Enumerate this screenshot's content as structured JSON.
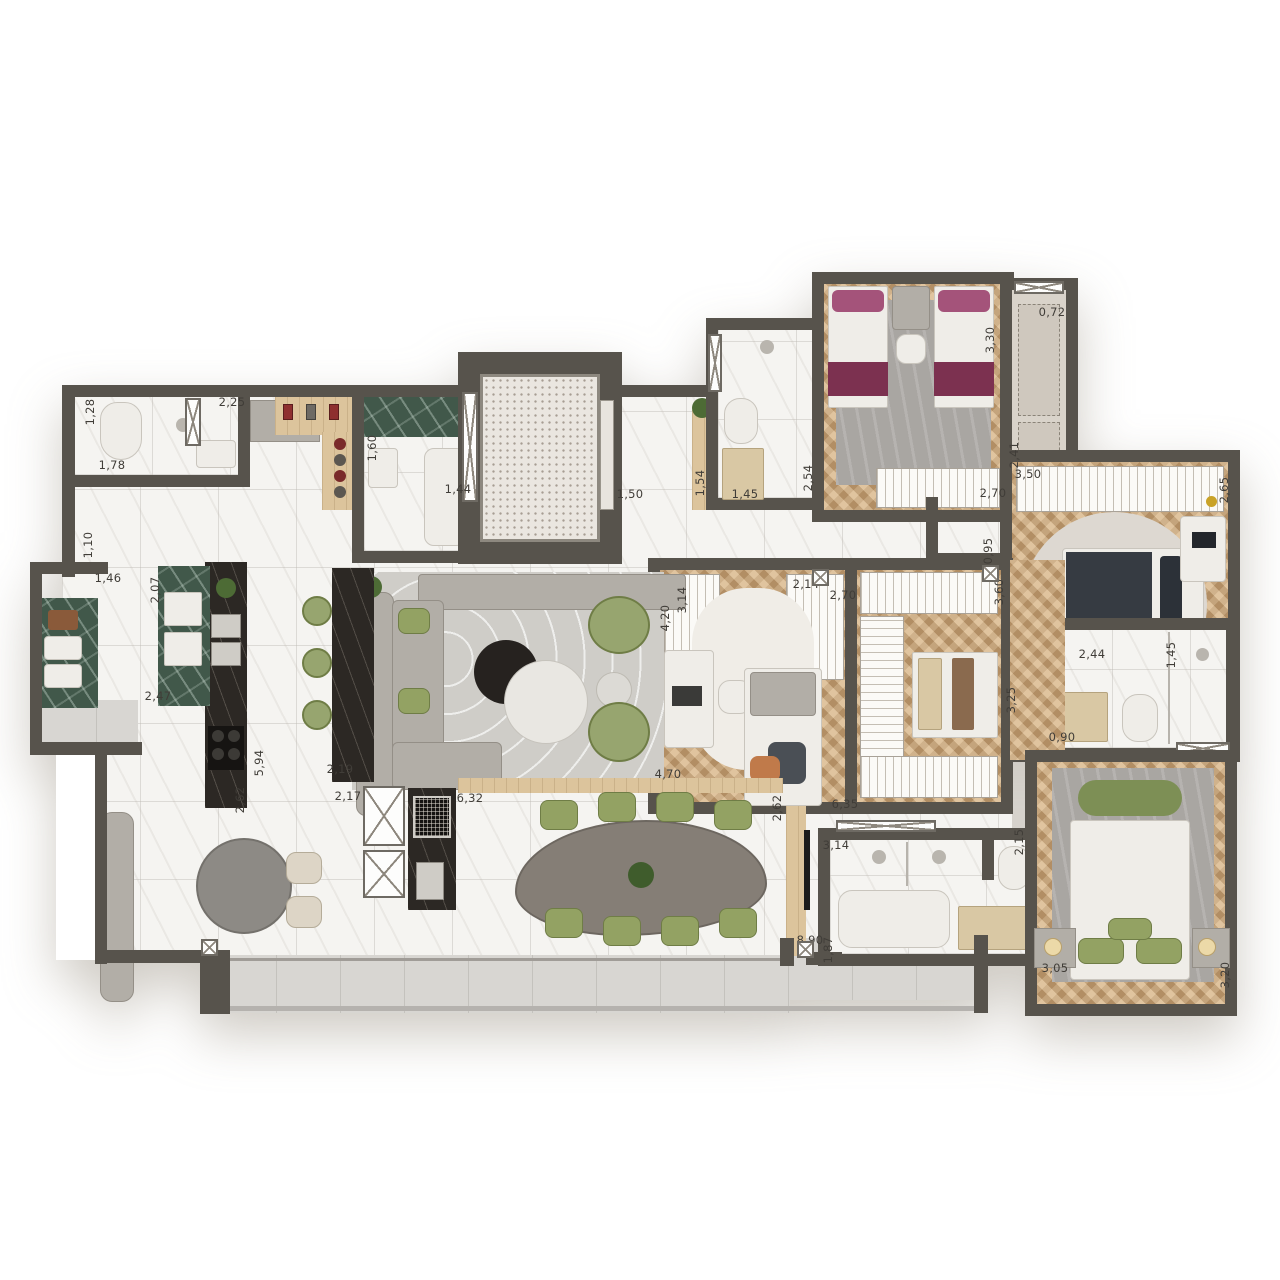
{
  "plan": {
    "type": "apartment-floor-plan",
    "units": "meters",
    "colors": {
      "wall": "#57534c",
      "marble_floor": "#f5f4f1",
      "wood_floor": "#c6a378",
      "green_marble": "#41584a",
      "dark_counter": "#2c2824",
      "balcony_floor": "#d8d6d2",
      "accent_green": "#93a263",
      "accent_burgundy": "#7c3150",
      "accent_charcoal": "#40454c"
    },
    "dimension_labels": [
      {
        "text": "1,28",
        "x": 90,
        "y": 412,
        "v": true
      },
      {
        "text": "2,25",
        "x": 232,
        "y": 402,
        "v": false
      },
      {
        "text": "1,78",
        "x": 112,
        "y": 465,
        "v": false
      },
      {
        "text": "1,60",
        "x": 372,
        "y": 448,
        "v": true
      },
      {
        "text": "1,44",
        "x": 458,
        "y": 489,
        "v": false
      },
      {
        "text": "1,50",
        "x": 630,
        "y": 494,
        "v": false
      },
      {
        "text": "1,54",
        "x": 700,
        "y": 483,
        "v": true
      },
      {
        "text": "1,45",
        "x": 745,
        "y": 494,
        "v": false
      },
      {
        "text": "2,54",
        "x": 808,
        "y": 478,
        "v": true
      },
      {
        "text": "1,10",
        "x": 88,
        "y": 545,
        "v": true
      },
      {
        "text": "1,46",
        "x": 108,
        "y": 578,
        "v": false
      },
      {
        "text": "2,07",
        "x": 155,
        "y": 590,
        "v": true
      },
      {
        "text": "2,47",
        "x": 158,
        "y": 696,
        "v": false
      },
      {
        "text": "5,94",
        "x": 259,
        "y": 763,
        "v": true
      },
      {
        "text": "2,19",
        "x": 340,
        "y": 769,
        "v": false
      },
      {
        "text": "2,62",
        "x": 240,
        "y": 800,
        "v": true
      },
      {
        "text": "2,17",
        "x": 348,
        "y": 796,
        "v": false
      },
      {
        "text": "6,32",
        "x": 470,
        "y": 798,
        "v": false
      },
      {
        "text": "3,30",
        "x": 990,
        "y": 340,
        "v": true
      },
      {
        "text": "0,72",
        "x": 1052,
        "y": 312,
        "v": false
      },
      {
        "text": "2,41",
        "x": 1014,
        "y": 455,
        "v": true
      },
      {
        "text": "2,70",
        "x": 993,
        "y": 493,
        "v": false
      },
      {
        "text": "3,50",
        "x": 1028,
        "y": 474,
        "v": false
      },
      {
        "text": "2,65",
        "x": 1224,
        "y": 490,
        "v": true
      },
      {
        "text": "0,95",
        "x": 988,
        "y": 551,
        "v": true
      },
      {
        "text": "3,60",
        "x": 999,
        "y": 592,
        "v": true
      },
      {
        "text": "3,25",
        "x": 1011,
        "y": 700,
        "v": true
      },
      {
        "text": "2,44",
        "x": 1092,
        "y": 654,
        "v": false
      },
      {
        "text": "1,45",
        "x": 1171,
        "y": 655,
        "v": true
      },
      {
        "text": "0,90",
        "x": 1062,
        "y": 737,
        "v": false
      },
      {
        "text": "3,14",
        "x": 682,
        "y": 600,
        "v": true
      },
      {
        "text": "2,14",
        "x": 806,
        "y": 584,
        "v": false
      },
      {
        "text": "4,20",
        "x": 665,
        "y": 618,
        "v": true
      },
      {
        "text": "2,70",
        "x": 843,
        "y": 595,
        "v": false
      },
      {
        "text": "4,70",
        "x": 668,
        "y": 774,
        "v": false
      },
      {
        "text": "2,62",
        "x": 777,
        "y": 808,
        "v": true
      },
      {
        "text": "6,35",
        "x": 845,
        "y": 804,
        "v": false
      },
      {
        "text": "3,14",
        "x": 836,
        "y": 845,
        "v": false
      },
      {
        "text": "1,87",
        "x": 828,
        "y": 950,
        "v": true
      },
      {
        "text": "2,15",
        "x": 1019,
        "y": 842,
        "v": true
      },
      {
        "text": "8,90",
        "x": 810,
        "y": 940,
        "v": false
      },
      {
        "text": "3,05",
        "x": 1055,
        "y": 968,
        "v": false
      },
      {
        "text": "3,20",
        "x": 1225,
        "y": 975,
        "v": true
      }
    ],
    "door_markers": [
      {
        "x": 821,
        "y": 578
      },
      {
        "x": 991,
        "y": 574
      },
      {
        "x": 806,
        "y": 950
      },
      {
        "x": 210,
        "y": 948
      }
    ]
  }
}
